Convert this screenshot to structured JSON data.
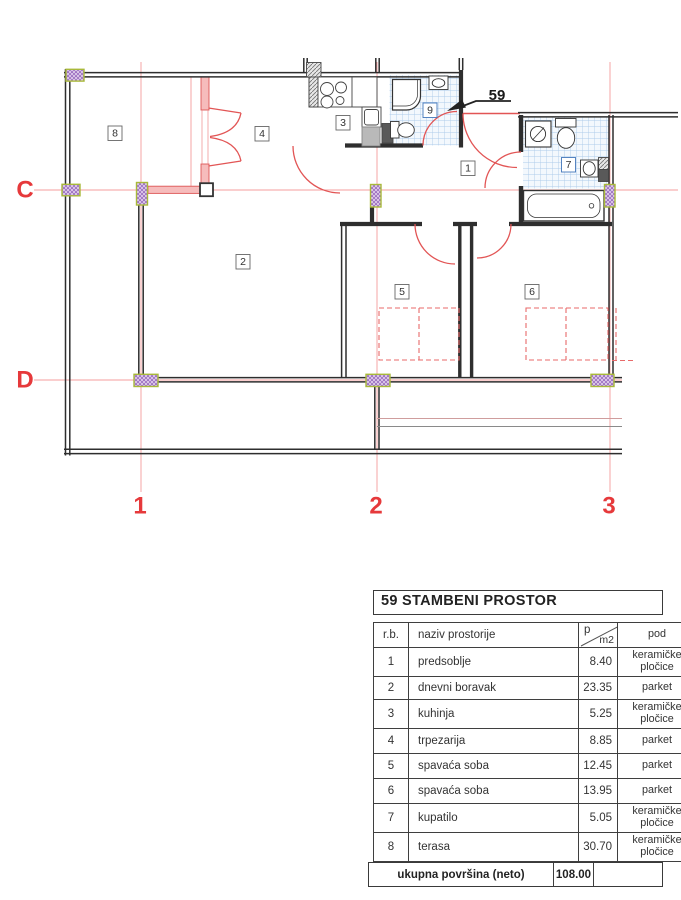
{
  "plan": {
    "unit_label": "59",
    "grid": {
      "c1": "1",
      "c2": "2",
      "c3": "3",
      "rC": "C",
      "rD": "D"
    },
    "rooms": {
      "n1": "1",
      "n2": "2",
      "n3": "3",
      "n4": "4",
      "n5": "5",
      "n6": "6",
      "n7": "7",
      "n8": "8",
      "n9": "9"
    },
    "colors": {
      "grid_line": "#f49c9c",
      "grid_label": "#e6393b",
      "wall": "#2e2e2e",
      "door_arc": "#e25555",
      "red_wall_fill": "#f6bcbc",
      "tile_line": "#aecbea",
      "column_hatch": "#9b6fc0",
      "column_border": "#a9b93a"
    }
  },
  "table": {
    "title": "59 STAMBENI PROSTOR",
    "columns": {
      "rb": "r.b.",
      "naziv": "naziv prostorije",
      "p": "p",
      "m2": "m2",
      "pod": "pod"
    },
    "rows": [
      {
        "rb": "1",
        "naziv": "predsoblje",
        "p": "8.40",
        "pod": "keramičke pločice"
      },
      {
        "rb": "2",
        "naziv": "dnevni boravak",
        "p": "23.35",
        "pod": "parket"
      },
      {
        "rb": "3",
        "naziv": "kuhinja",
        "p": "5.25",
        "pod": "keramičke pločice"
      },
      {
        "rb": "4",
        "naziv": "trpezarija",
        "p": "8.85",
        "pod": "parket"
      },
      {
        "rb": "5",
        "naziv": "spavaća soba",
        "p": "12.45",
        "pod": "parket"
      },
      {
        "rb": "6",
        "naziv": "spavaća soba",
        "p": "13.95",
        "pod": "parket"
      },
      {
        "rb": "7",
        "naziv": "kupatilo",
        "p": "5.05",
        "pod": "keramičke pločice"
      },
      {
        "rb": "8",
        "naziv": "terasa",
        "p": "30.70",
        "pod": "keramičke pločice"
      }
    ],
    "total": {
      "label": "ukupna površina (neto)",
      "value": "108.00"
    }
  }
}
